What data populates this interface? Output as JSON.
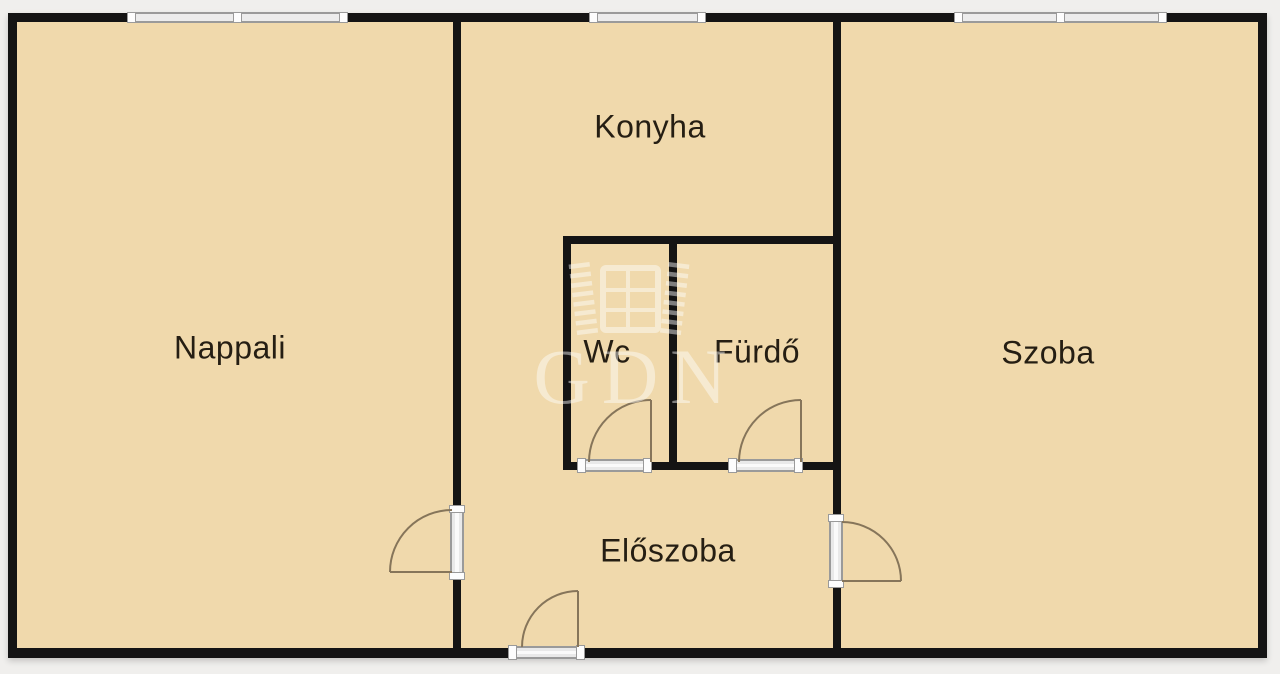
{
  "plan": {
    "type": "apartment-floor-plan",
    "rooms": [
      {
        "id": "nappali",
        "label": "Nappali"
      },
      {
        "id": "konyha",
        "label": "Konyha"
      },
      {
        "id": "wc",
        "label": "Wc"
      },
      {
        "id": "furdo",
        "label": "Fürdő"
      },
      {
        "id": "szoba",
        "label": "Szoba"
      },
      {
        "id": "eloszoba",
        "label": "Előszoba"
      }
    ],
    "fixtures": {
      "windows": [
        "nappali-window",
        "konyha-window",
        "szoba-window"
      ],
      "doors": [
        "nappali-door",
        "szoba-door",
        "wc-door",
        "furdo-door",
        "entrance-door"
      ]
    }
  },
  "watermark": {
    "text": "GDN",
    "icon": "open-window-logo-icon",
    "opacity": 0.45
  },
  "colors": {
    "floor": "#F0D9AC",
    "wall": "#141414",
    "background": "#F0EFED",
    "threshold_edge": "#9A9A9A",
    "threshold_fill": "#ECECEC",
    "door_arc": "#86755A",
    "label_text": "#251E13",
    "watermark": "#FFFFFF"
  }
}
